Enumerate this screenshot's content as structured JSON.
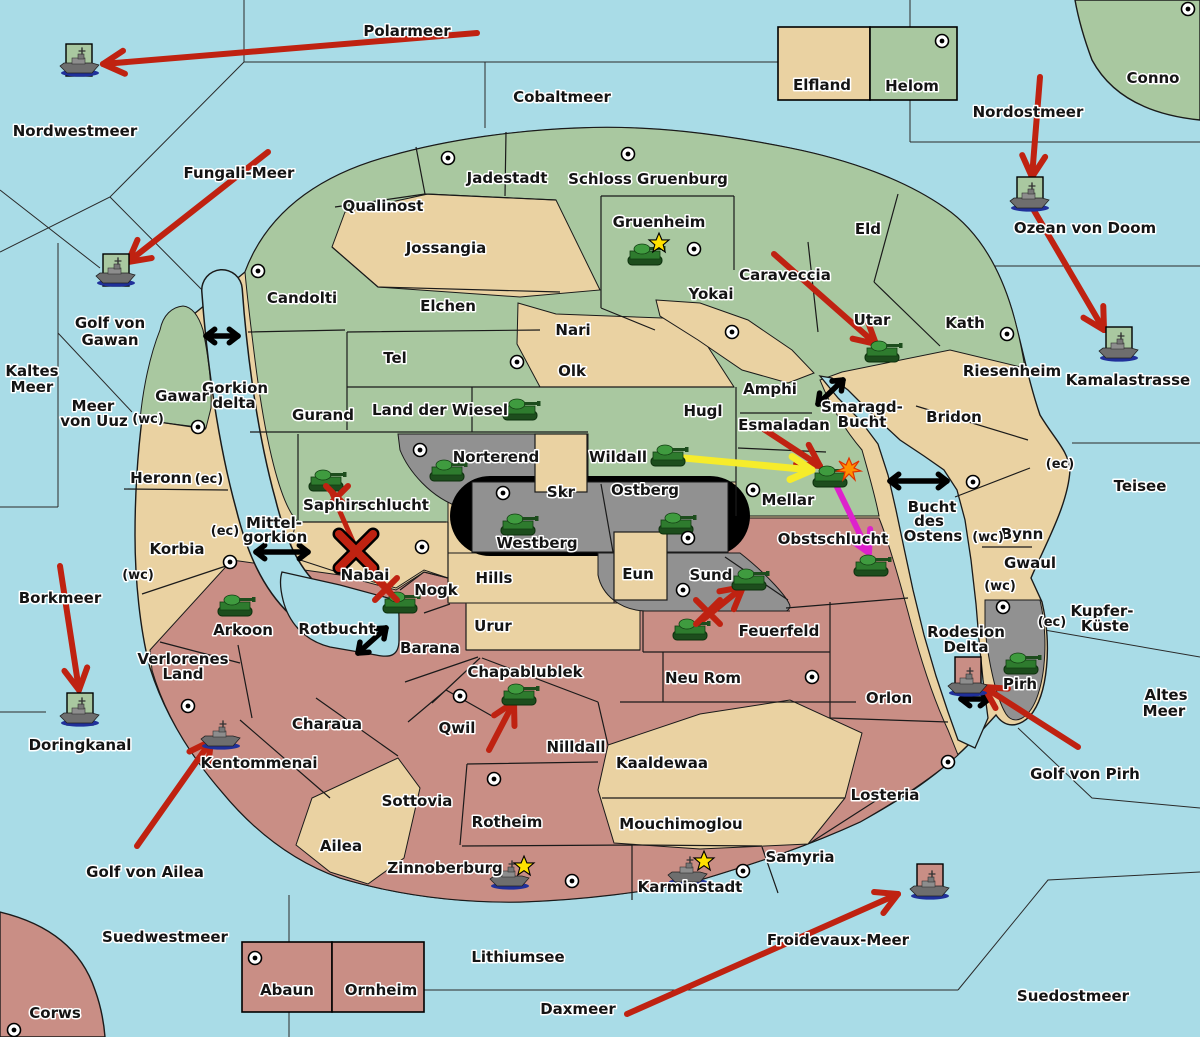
{
  "map": {
    "colors": {
      "sea": "#a9dce7",
      "land_green": "#a9c8a0",
      "land_tan": "#ead2a2",
      "land_pink": "#c98e85",
      "land_gray": "#919191",
      "black_ridge": "#000000",
      "attack_red": "#bf2211",
      "move_yellow": "#f6ec2b",
      "move_magenta": "#dd22cc",
      "link_black": "#000000",
      "star_yellow": "#ffe100",
      "explosion_orange": "#ff9000"
    },
    "sea_labels": [
      {
        "t": "Polarmeer",
        "x": 407,
        "y": 36
      },
      {
        "t": "Nordwestmeer",
        "x": 75,
        "y": 136
      },
      {
        "t": "Cobaltmeer",
        "x": 562,
        "y": 102
      },
      {
        "t": "Nordostmeer",
        "x": 1028,
        "y": 117
      },
      {
        "t": "Ozean von Doom",
        "x": 1085,
        "y": 233
      },
      {
        "t": "Fungali-Meer",
        "x": 239,
        "y": 178
      },
      {
        "t": "Golf von",
        "x": 110,
        "y": 328
      },
      {
        "t": "Gawan",
        "x": 110,
        "y": 345
      },
      {
        "t": "Kaltes",
        "x": 32,
        "y": 376
      },
      {
        "t": "Meer",
        "x": 32,
        "y": 392
      },
      {
        "t": "Meer",
        "x": 93,
        "y": 411
      },
      {
        "t": "von Uuz",
        "x": 94,
        "y": 426
      },
      {
        "t": "Gorkion",
        "x": 235,
        "y": 393
      },
      {
        "t": "delta",
        "x": 234,
        "y": 408
      },
      {
        "t": "Mittel-",
        "x": 274,
        "y": 528
      },
      {
        "t": "gorkion",
        "x": 275,
        "y": 542
      },
      {
        "t": "Borkmeer",
        "x": 60,
        "y": 603
      },
      {
        "t": "Doringkanal",
        "x": 80,
        "y": 750
      },
      {
        "t": "Golf von Ailea",
        "x": 145,
        "y": 877
      },
      {
        "t": "Suedwestmeer",
        "x": 165,
        "y": 942
      },
      {
        "t": "Lithiumsee",
        "x": 518,
        "y": 962
      },
      {
        "t": "Daxmeer",
        "x": 578,
        "y": 1014
      },
      {
        "t": "Froidevaux-Meer",
        "x": 838,
        "y": 945
      },
      {
        "t": "Suedostmeer",
        "x": 1073,
        "y": 1001
      },
      {
        "t": "Altes",
        "x": 1166,
        "y": 700
      },
      {
        "t": "Meer",
        "x": 1164,
        "y": 716
      },
      {
        "t": "Kupfer-",
        "x": 1102,
        "y": 616
      },
      {
        "t": "Küste",
        "x": 1105,
        "y": 631
      },
      {
        "t": "Golf von Pirh",
        "x": 1085,
        "y": 779
      },
      {
        "t": "Kamalastrasse",
        "x": 1128,
        "y": 385
      },
      {
        "t": "Teisee",
        "x": 1140,
        "y": 491
      },
      {
        "t": "Bucht",
        "x": 932,
        "y": 512
      },
      {
        "t": "des",
        "x": 929,
        "y": 526
      },
      {
        "t": "Ostens",
        "x": 933,
        "y": 541
      },
      {
        "t": "Smaragd-",
        "x": 862,
        "y": 412
      },
      {
        "t": "Bucht",
        "x": 862,
        "y": 427
      },
      {
        "t": "Rotbucht",
        "x": 337,
        "y": 634
      }
    ],
    "territory_labels": [
      {
        "t": "Qualinost",
        "x": 383,
        "y": 211
      },
      {
        "t": "Jadestadt",
        "x": 507,
        "y": 183
      },
      {
        "t": "Schloss Gruenburg",
        "x": 648,
        "y": 184
      },
      {
        "t": "Gruenheim",
        "x": 659,
        "y": 227
      },
      {
        "t": "Jossangia",
        "x": 446,
        "y": 253
      },
      {
        "t": "Candolti",
        "x": 302,
        "y": 303
      },
      {
        "t": "Elchen",
        "x": 448,
        "y": 311
      },
      {
        "t": "Yokai",
        "x": 711,
        "y": 299
      },
      {
        "t": "Caraveccia",
        "x": 785,
        "y": 280
      },
      {
        "t": "Nari",
        "x": 573,
        "y": 335
      },
      {
        "t": "Olk",
        "x": 572,
        "y": 376
      },
      {
        "t": "Tel",
        "x": 395,
        "y": 363
      },
      {
        "t": "Gurand",
        "x": 323,
        "y": 420
      },
      {
        "t": "Land der Wiesel",
        "x": 440,
        "y": 415
      },
      {
        "t": "Hugl",
        "x": 703,
        "y": 416
      },
      {
        "t": "Amphi",
        "x": 770,
        "y": 394
      },
      {
        "t": "Eld",
        "x": 868,
        "y": 234
      },
      {
        "t": "Utar",
        "x": 872,
        "y": 325
      },
      {
        "t": "Kath",
        "x": 965,
        "y": 328
      },
      {
        "t": "Esmaladan",
        "x": 784,
        "y": 430
      },
      {
        "t": "Wildall",
        "x": 618,
        "y": 462
      },
      {
        "t": "Mellar",
        "x": 788,
        "y": 505
      },
      {
        "t": "Norterend",
        "x": 496,
        "y": 462
      },
      {
        "t": "Skr",
        "x": 561,
        "y": 497
      },
      {
        "t": "Ostberg",
        "x": 645,
        "y": 495
      },
      {
        "t": "Westberg",
        "x": 537,
        "y": 548
      },
      {
        "t": "Riesenheim",
        "x": 1012,
        "y": 376
      },
      {
        "t": "Bridon",
        "x": 954,
        "y": 422
      },
      {
        "t": "Bynn",
        "x": 1022,
        "y": 539
      },
      {
        "t": "Gwaul",
        "x": 1030,
        "y": 568
      },
      {
        "t": "Gawar",
        "x": 182,
        "y": 401
      },
      {
        "t": "Heronn",
        "x": 161,
        "y": 483
      },
      {
        "t": "Korbia",
        "x": 177,
        "y": 554
      },
      {
        "t": "Saphirschlucht",
        "x": 366,
        "y": 510
      },
      {
        "t": "Nabai",
        "x": 365,
        "y": 580
      },
      {
        "t": "Nogk",
        "x": 436,
        "y": 595
      },
      {
        "t": "Hills",
        "x": 494,
        "y": 583
      },
      {
        "t": "Arkoon",
        "x": 243,
        "y": 635
      },
      {
        "t": "Verlorenes",
        "x": 183,
        "y": 664
      },
      {
        "t": "Land",
        "x": 183,
        "y": 679
      },
      {
        "t": "Charaua",
        "x": 327,
        "y": 729
      },
      {
        "t": "Kentommenai",
        "x": 259,
        "y": 768
      },
      {
        "t": "Ailea",
        "x": 341,
        "y": 851
      },
      {
        "t": "Sottovia",
        "x": 417,
        "y": 806
      },
      {
        "t": "Qwil",
        "x": 457,
        "y": 733
      },
      {
        "t": "Chapablublek",
        "x": 525,
        "y": 677
      },
      {
        "t": "Barana",
        "x": 430,
        "y": 653
      },
      {
        "t": "Urur",
        "x": 493,
        "y": 631
      },
      {
        "t": "Nilldall",
        "x": 576,
        "y": 752
      },
      {
        "t": "Kaaldewaa",
        "x": 662,
        "y": 768
      },
      {
        "t": "Neu Rom",
        "x": 703,
        "y": 683
      },
      {
        "t": "Feuerfeld",
        "x": 779,
        "y": 636
      },
      {
        "t": "Mouchimoglou",
        "x": 681,
        "y": 829
      },
      {
        "t": "Rotheim",
        "x": 507,
        "y": 827
      },
      {
        "t": "Zinnoberburg",
        "x": 445,
        "y": 873
      },
      {
        "t": "Karminstadt",
        "x": 690,
        "y": 892
      },
      {
        "t": "Samyria",
        "x": 800,
        "y": 862
      },
      {
        "t": "Losteria",
        "x": 885,
        "y": 800
      },
      {
        "t": "Orlon",
        "x": 889,
        "y": 703
      },
      {
        "t": "Obstschlucht",
        "x": 833,
        "y": 544
      },
      {
        "t": "Sund",
        "x": 711,
        "y": 580
      },
      {
        "t": "Eun",
        "x": 638,
        "y": 579
      },
      {
        "t": "Rodesion",
        "x": 966,
        "y": 637
      },
      {
        "t": "Delta",
        "x": 966,
        "y": 652
      },
      {
        "t": "Pirh",
        "x": 1020,
        "y": 689
      },
      {
        "t": "Elfland",
        "x": 822,
        "y": 90
      },
      {
        "t": "Helom",
        "x": 912,
        "y": 91
      },
      {
        "t": "Abaun",
        "x": 287,
        "y": 995
      },
      {
        "t": "Ornheim",
        "x": 381,
        "y": 995
      },
      {
        "t": "Conno",
        "x": 1153,
        "y": 83
      },
      {
        "t": "Corws",
        "x": 55,
        "y": 1018
      }
    ],
    "small_labels": [
      {
        "t": "(wc)",
        "x": 148,
        "y": 423
      },
      {
        "t": "(wc)",
        "x": 138,
        "y": 579
      },
      {
        "t": "(wc)",
        "x": 988,
        "y": 541
      },
      {
        "t": "(wc)",
        "x": 1000,
        "y": 590
      },
      {
        "t": "(ec)",
        "x": 209,
        "y": 483
      },
      {
        "t": "(ec)",
        "x": 225,
        "y": 535
      },
      {
        "t": "(ec)",
        "x": 1060,
        "y": 468
      },
      {
        "t": "(ec)",
        "x": 1052,
        "y": 626
      }
    ],
    "cities": [
      {
        "x": 448,
        "y": 158
      },
      {
        "x": 628,
        "y": 154
      },
      {
        "x": 694,
        "y": 249
      },
      {
        "x": 942,
        "y": 41
      },
      {
        "x": 1188,
        "y": 9
      },
      {
        "x": 258,
        "y": 271
      },
      {
        "x": 198,
        "y": 427
      },
      {
        "x": 517,
        "y": 362
      },
      {
        "x": 732,
        "y": 332
      },
      {
        "x": 1007,
        "y": 334
      },
      {
        "x": 973,
        "y": 482
      },
      {
        "x": 420,
        "y": 450
      },
      {
        "x": 503,
        "y": 493
      },
      {
        "x": 688,
        "y": 538
      },
      {
        "x": 753,
        "y": 490
      },
      {
        "x": 422,
        "y": 547
      },
      {
        "x": 230,
        "y": 562
      },
      {
        "x": 188,
        "y": 706
      },
      {
        "x": 460,
        "y": 696
      },
      {
        "x": 494,
        "y": 779
      },
      {
        "x": 812,
        "y": 677
      },
      {
        "x": 683,
        "y": 590
      },
      {
        "x": 948,
        "y": 762
      },
      {
        "x": 1003,
        "y": 607
      },
      {
        "x": 572,
        "y": 881
      },
      {
        "x": 743,
        "y": 871
      },
      {
        "x": 255,
        "y": 958
      },
      {
        "x": 14,
        "y": 1030
      }
    ],
    "tanks": [
      {
        "x": 645,
        "y": 255,
        "loc": "Gruenheim"
      },
      {
        "x": 520,
        "y": 410,
        "loc": "Land der Wiesel"
      },
      {
        "x": 447,
        "y": 471,
        "loc": "Norterend"
      },
      {
        "x": 518,
        "y": 525,
        "loc": "Westberg"
      },
      {
        "x": 676,
        "y": 524,
        "loc": "Ostberg"
      },
      {
        "x": 668,
        "y": 456,
        "loc": "Wildall"
      },
      {
        "x": 830,
        "y": 477,
        "loc": "Mellar"
      },
      {
        "x": 871,
        "y": 566,
        "loc": "Obstschlucht"
      },
      {
        "x": 882,
        "y": 352,
        "loc": "Utar"
      },
      {
        "x": 326,
        "y": 481,
        "loc": "Saphirschlucht"
      },
      {
        "x": 400,
        "y": 603,
        "loc": "Nogk"
      },
      {
        "x": 235,
        "y": 606,
        "loc": "Arkoon"
      },
      {
        "x": 749,
        "y": 580,
        "loc": "Sund"
      },
      {
        "x": 690,
        "y": 630,
        "loc": "Feuerfeld"
      },
      {
        "x": 519,
        "y": 695,
        "loc": "Chapablublek"
      },
      {
        "x": 1021,
        "y": 664,
        "loc": "Pirh"
      }
    ],
    "ships": [
      {
        "x": 80,
        "y": 64,
        "tile": "green",
        "tx": 66,
        "ty": 44,
        "loc": "Nordwestmeer"
      },
      {
        "x": 116,
        "y": 274,
        "tile": "green",
        "tx": 103,
        "ty": 254,
        "loc": "Golf von Gawan"
      },
      {
        "x": 1030,
        "y": 199,
        "tile": "green",
        "tx": 1017,
        "ty": 177,
        "loc": "Ozean von Doom"
      },
      {
        "x": 1119,
        "y": 349,
        "tile": "green",
        "tx": 1106,
        "ty": 327,
        "loc": "Kamalastrasse"
      },
      {
        "x": 80,
        "y": 714,
        "tile": "green",
        "tx": 67,
        "ty": 693,
        "loc": "Doringkanal"
      },
      {
        "x": 221,
        "y": 737,
        "tile": null,
        "loc": "Kentommenai"
      },
      {
        "x": 510,
        "y": 877,
        "tile": null,
        "loc": "Zinnoberburg"
      },
      {
        "x": 688,
        "y": 873,
        "tile": null,
        "loc": "Karminstadt"
      },
      {
        "x": 968,
        "y": 684,
        "tile": "pink",
        "tx": 955,
        "ty": 657,
        "loc": "Rodesion Delta"
      },
      {
        "x": 930,
        "y": 887,
        "tile": "pink",
        "tx": 917,
        "ty": 864,
        "loc": "Froidevaux-Meer"
      }
    ],
    "stars": [
      {
        "x": 659,
        "y": 243
      },
      {
        "x": 524,
        "y": 866
      },
      {
        "x": 704,
        "y": 861
      }
    ],
    "explosions": [
      {
        "x": 849,
        "y": 469
      }
    ],
    "battle_marks": [
      {
        "x": 356,
        "y": 551,
        "size": 17,
        "big": true
      },
      {
        "x": 337,
        "y": 497,
        "size": 11,
        "big": false
      },
      {
        "x": 386,
        "y": 589,
        "size": 11,
        "big": false
      },
      {
        "x": 708,
        "y": 612,
        "size": 12,
        "big": false
      }
    ],
    "move_arrows": [
      {
        "x1": 477,
        "y1": 33,
        "x2": 103,
        "y2": 64,
        "c": "red",
        "w": 6,
        "head": true
      },
      {
        "x1": 268,
        "y1": 152,
        "x2": 128,
        "y2": 262,
        "c": "red",
        "w": 6,
        "head": true
      },
      {
        "x1": 1040,
        "y1": 77,
        "x2": 1032,
        "y2": 177,
        "c": "red",
        "w": 6,
        "head": true
      },
      {
        "x1": 1029,
        "y1": 202,
        "x2": 1104,
        "y2": 330,
        "c": "red",
        "w": 6,
        "head": true
      },
      {
        "x1": 774,
        "y1": 254,
        "x2": 876,
        "y2": 344,
        "c": "red",
        "w": 6,
        "head": true
      },
      {
        "x1": 762,
        "y1": 428,
        "x2": 820,
        "y2": 466,
        "c": "red",
        "w": 6,
        "head": true
      },
      {
        "x1": 60,
        "y1": 566,
        "x2": 79,
        "y2": 690,
        "c": "red",
        "w": 6,
        "head": true
      },
      {
        "x1": 137,
        "y1": 846,
        "x2": 211,
        "y2": 741,
        "c": "red",
        "w": 6,
        "head": true
      },
      {
        "x1": 627,
        "y1": 1014,
        "x2": 898,
        "y2": 894,
        "c": "red",
        "w": 6,
        "head": true
      },
      {
        "x1": 1078,
        "y1": 747,
        "x2": 984,
        "y2": 687,
        "c": "red",
        "w": 6,
        "head": true
      },
      {
        "x1": 489,
        "y1": 750,
        "x2": 514,
        "y2": 702,
        "c": "red",
        "w": 6,
        "head": true
      },
      {
        "x1": 695,
        "y1": 626,
        "x2": 743,
        "y2": 587,
        "c": "red",
        "w": 6,
        "head": true
      },
      {
        "x1": 330,
        "y1": 489,
        "x2": 355,
        "y2": 546,
        "c": "red",
        "w": 5,
        "head": false
      },
      {
        "x1": 397,
        "y1": 600,
        "x2": 362,
        "y2": 557,
        "c": "red",
        "w": 5,
        "head": false
      },
      {
        "x1": 684,
        "y1": 458,
        "x2": 812,
        "y2": 470,
        "c": "yellow",
        "w": 7,
        "head": true
      },
      {
        "x1": 837,
        "y1": 487,
        "x2": 869,
        "y2": 553,
        "c": "magenta",
        "w": 6,
        "head": true
      }
    ],
    "link_arrows": [
      {
        "x1": 206,
        "y1": 336,
        "x2": 238,
        "y2": 336
      },
      {
        "x1": 256,
        "y1": 552,
        "x2": 308,
        "y2": 552
      },
      {
        "x1": 818,
        "y1": 404,
        "x2": 843,
        "y2": 380
      },
      {
        "x1": 890,
        "y1": 481,
        "x2": 947,
        "y2": 481
      },
      {
        "x1": 358,
        "y1": 653,
        "x2": 386,
        "y2": 628
      },
      {
        "x1": 961,
        "y1": 699,
        "x2": 989,
        "y2": 699
      }
    ]
  }
}
